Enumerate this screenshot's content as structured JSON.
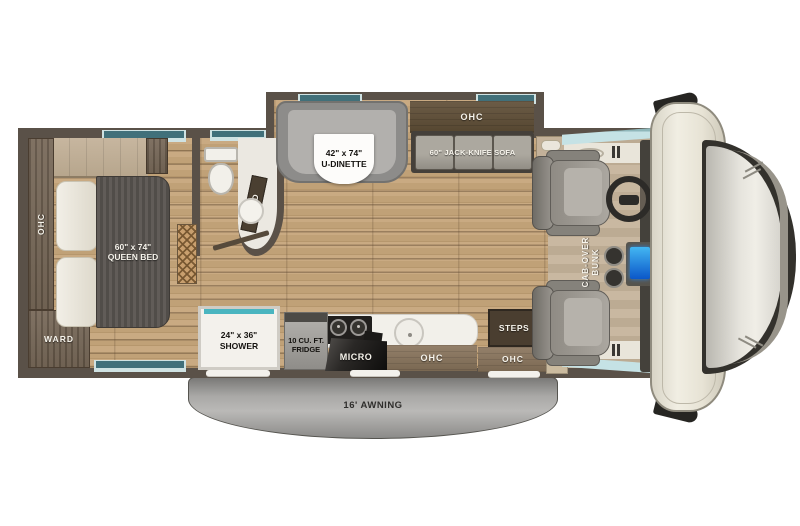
{
  "floorplan": {
    "bedroom": {
      "ohc": "OHC",
      "ward": "WARD",
      "bed": {
        "size": "60\" x 74\"",
        "name": "QUEEN BED"
      }
    },
    "bathroom": {
      "med": "MED"
    },
    "living": {
      "dinette": {
        "size": "42\" x 74\"",
        "name": "U-DINETTE"
      },
      "sofa_ohc": "OHC",
      "sofa": "60\" JACK-KNIFE SOFA"
    },
    "kitchen": {
      "shower": {
        "size": "24\" x 36\"",
        "name": "SHOWER"
      },
      "fridge": {
        "line1": "10 CU. FT.",
        "line2": "FRIDGE"
      },
      "micro": "MICRO",
      "ohc": "OHC"
    },
    "entry": {
      "steps": "STEPS",
      "ohc": "OHC",
      "tv": "TV"
    },
    "cab": {
      "bunk_line1": "CAB-OVER",
      "bunk_line2": "BUNK"
    },
    "exterior": {
      "awning": "16' AWNING"
    },
    "colors": {
      "wall": "#5a5148",
      "floor_wood": "#c2a27c",
      "cabinet_wood": "#6e5f4e",
      "accent_teal": "#4ab5c0",
      "awning_gray": "#9b9a98",
      "window_blue": "#c5e2e5"
    }
  }
}
